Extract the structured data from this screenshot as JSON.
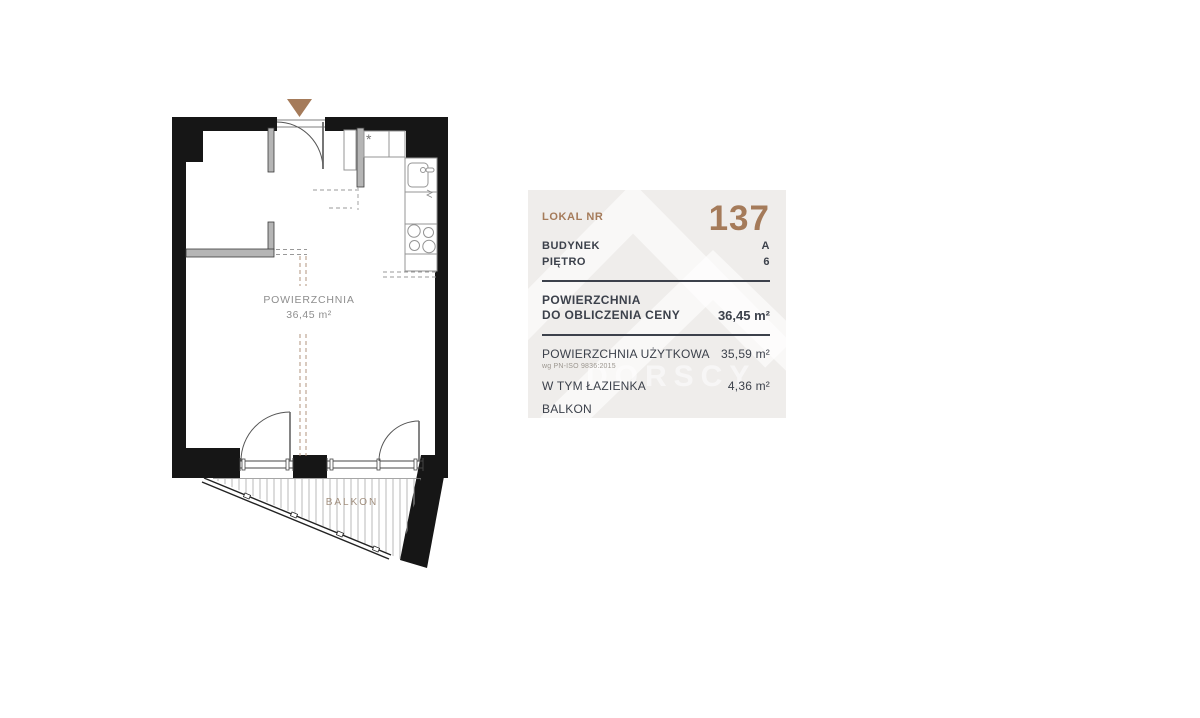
{
  "floor_plan": {
    "area_label": "POWIERZCHNIA",
    "area_value": "36,45 m²",
    "balcony_label": "BALKON",
    "stove_symbol": "*"
  },
  "panel": {
    "lokal_label": "LOKAL NR",
    "lokal_value": "137",
    "budynek_label": "BUDYNEK",
    "budynek_value": "A",
    "pietro_label": "PIĘTRO",
    "pietro_value": "6",
    "price_area_label_line1": "POWIERZCHNIA",
    "price_area_label_line2": "DO OBLICZENIA CENY",
    "price_area_value": "36,45 m²",
    "usable_area_label": "POWIERZCHNIA UŻYTKOWA",
    "usable_area_note": "wg PN-ISO 9836:2015",
    "usable_area_value": "35,59 m²",
    "bathroom_label": "W TYM ŁAZIENKA",
    "bathroom_value": "4,36 m²",
    "balcony_label": "BALKON",
    "balcony_value": ""
  },
  "watermark": {
    "text": "DORSCY"
  },
  "colors": {
    "accent_brown": "#a57b5a",
    "panel_bg": "#efedeb",
    "panel_text": "#3c414b",
    "wall_black": "#161616",
    "plan_text_gray": "#8e8e8e",
    "balcony_text": "#a2907f",
    "watermark_white": "#ffffff"
  }
}
